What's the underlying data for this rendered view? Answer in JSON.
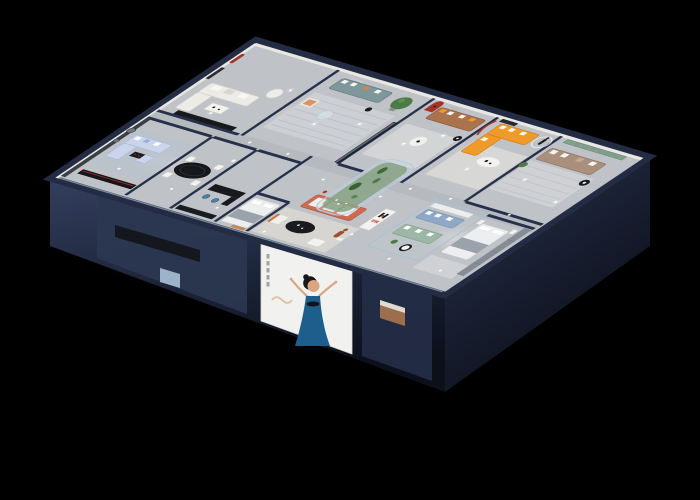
{
  "scene": {
    "description": "Isometric 3D cutaway render of a HUAYUE furniture showroom floor plan on a black background",
    "background_color": "#000000",
    "brand": {
      "monogram": "H",
      "name_cn": "华悦",
      "name_en": "HUAYUE",
      "logo_red": "#c0392b",
      "logo_black": "#17181c"
    },
    "palette": {
      "wall_top_navy": "#27304a",
      "facade_dark": "#1a2238",
      "floor_gray": "#bfc2c6",
      "accent_red_arch": "#a33228",
      "sofa_orange": "#f09a2c",
      "sofa_blue": "#cad5ec",
      "sofa_teal": "#7d979b",
      "sofa_brown": "#aa724d",
      "sofa_salmon": "#cd6a52",
      "sofa_taupe": "#a98f7c",
      "sofa_sage": "#9cb7a6",
      "sofa_denim": "#8fa8c8",
      "plant_green": "#4c7a45",
      "display_floor_green": "#87a284",
      "glass_tint": "#a9c2d4"
    },
    "rooms": [
      {
        "id": "living-room-cream",
        "furniture": [
          "white-l-sofa",
          "white-coffee-table",
          "black-media-console",
          "red-arch-niche",
          "tall-mirror",
          "tub-chair"
        ]
      },
      {
        "id": "lounge-teal",
        "furniture": [
          "teal-sofa",
          "potted-tree",
          "cream-armchair-orange-cushion",
          "glass-coffee-table",
          "striped-rug",
          "smoked-glass-panel",
          "wall-arc-decor"
        ]
      },
      {
        "id": "lounge-brown",
        "furniture": [
          "brown-leather-sofa",
          "yellow-and-white-pillows",
          "red-arch-niche-with-figurine",
          "white-round-coffee-table",
          "black-side-table",
          "wall-tagline-microtext"
        ]
      },
      {
        "id": "lounge-orange",
        "furniture": [
          "orange-l-sofa",
          "white-oval-coffee-table",
          "dark-wall-art",
          "red-curve-wall-decor",
          "statue-with-white-ring"
        ]
      },
      {
        "id": "lounge-taupe",
        "furniture": [
          "taupe-sofa",
          "green-recessed-shelf",
          "huayue-wall-letters",
          "black-round-table",
          "plant",
          "striped-rug"
        ]
      },
      {
        "id": "media-room-blue",
        "furniture": [
          "light-blue-sectional-sofa",
          "black-coffee-table-red-accents",
          "black-media-console-red-light",
          "dark-accent-wall-round-art",
          "blue-gray-rug",
          "light-blue-cube-ottoman"
        ]
      },
      {
        "id": "dining-area",
        "furniture": [
          "black-oval-table",
          "white-chairs-x4",
          "white-floor-lamp"
        ]
      },
      {
        "id": "reception",
        "furniture": [
          "black-counter",
          "blue-stools-x2",
          "black-display-cabinet"
        ]
      },
      {
        "id": "bed-nook",
        "furniture": [
          "white-bed-gray-throw",
          "tan-bench"
        ]
      },
      {
        "id": "showroom-salmon",
        "furniture": [
          "salmon-sofa-white-cushions",
          "black-oval-coffee-table",
          "white-ottoman",
          "cream-armchair-orange-trim",
          "red-floor-lamp",
          "brand-logo-pillar"
        ]
      },
      {
        "id": "plant-display",
        "furniture": [
          "curved-glass-case",
          "cacti",
          "green-floor",
          "white-pebbles",
          "terracotta-statue"
        ]
      },
      {
        "id": "glass-lounge",
        "furniture": [
          "denim-blue-sofa",
          "sage-green-sofa",
          "black-white-round-table",
          "white-console",
          "plant"
        ]
      },
      {
        "id": "bedroom-gray",
        "furniture": [
          "white-bed-gray-throw",
          "white-nightstands",
          "rug",
          "gray-wardrobe"
        ]
      }
    ],
    "poster": {
      "subject": "woman-in-blue-dress",
      "panel_color": "#f1f1ef",
      "dress_color": "#1e5e8c"
    },
    "lighting": {
      "ceiling_spotlights": 23,
      "light_pools": 5
    }
  }
}
